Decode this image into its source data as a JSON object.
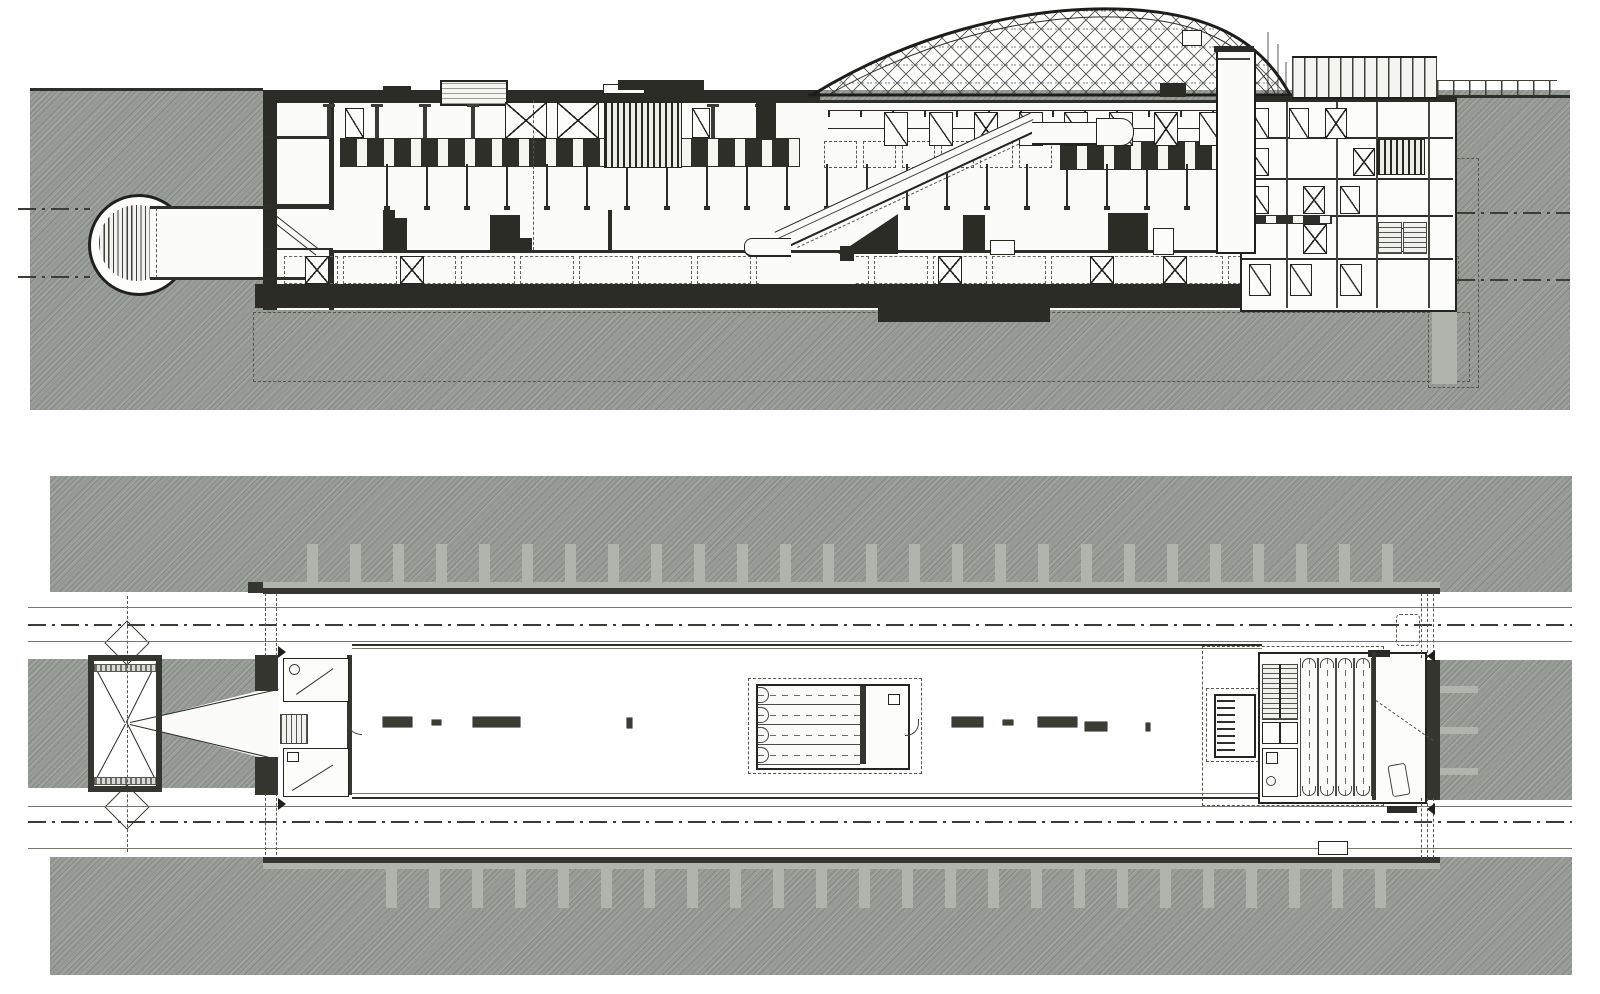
{
  "drawing": {
    "kind": "architectural-drawing",
    "views": [
      {
        "id": "section",
        "semantic": "longitudinal-section-of-underground-station"
      },
      {
        "id": "plan",
        "semantic": "platform-level-plan"
      }
    ],
    "has_text": false
  },
  "palette": {
    "paper": "#ffffff",
    "drawing_white": "#fbfbf9",
    "earth_hatch": "#989d97",
    "light_gray": "#b1b4ad",
    "wall_dark": "#35362f",
    "slab_dark": "#2b2c26",
    "ink": "#1f201b",
    "line_gray": "#74766f",
    "dash_gray": "#54554e"
  },
  "section": {
    "hangers": {
      "x0": 386,
      "pitch": 40,
      "count": 22,
      "y": 164,
      "w": 2,
      "h": 42
    },
    "concourse_columns": {
      "x0": 327,
      "pitch": 48,
      "count": 10,
      "y": 104,
      "w": 4,
      "h": 34
    },
    "underplatform_panels": {
      "x0": 284,
      "pitch": 59,
      "count": 20,
      "y": 256,
      "w": 52,
      "h": 26
    },
    "underplatform_xdoors": {
      "xs": [
        305,
        400,
        938,
        1090,
        1163
      ],
      "y": 256,
      "w": 22,
      "h": 26
    },
    "dashed_bays": {
      "x0": 824,
      "pitch": 39,
      "count": 6,
      "y": 141,
      "w": 31,
      "h": 25
    },
    "concourse_doors": {
      "x0": 884,
      "pitch": 45,
      "count": 8,
      "y": 112,
      "w": 22,
      "h": 32,
      "x_marked": [
        2,
        6
      ]
    },
    "platform_blocks": [
      {
        "x": 383,
        "y": 218,
        "w": 24,
        "h": 32
      },
      {
        "x": 383,
        "y": 210,
        "w": 12,
        "h": 8
      },
      {
        "x": 490,
        "y": 215,
        "w": 30,
        "h": 35
      },
      {
        "x": 520,
        "y": 238,
        "w": 12,
        "h": 12
      },
      {
        "x": 608,
        "y": 210,
        "w": 4,
        "h": 40
      },
      {
        "x": 963,
        "y": 215,
        "w": 22,
        "h": 38
      },
      {
        "x": 1108,
        "y": 213,
        "w": 40,
        "h": 40
      },
      {
        "x": 840,
        "y": 246,
        "w": 14,
        "h": 15
      }
    ],
    "platform_white_boxes": [
      {
        "x": 990,
        "y": 240,
        "w": 23,
        "h": 13
      },
      {
        "x": 1153,
        "y": 228,
        "w": 19,
        "h": 25
      },
      {
        "x": 1396,
        "y": 228,
        "w": 8,
        "h": 22
      }
    ],
    "dome": {
      "x": 798,
      "y": 2,
      "w": 500,
      "h": 97,
      "base_y": 93,
      "apex_x": 318,
      "apex_y": 7
    }
  },
  "plan": {
    "ribs_top": {
      "x0": 307,
      "pitch": 43,
      "count": 26,
      "y": 544,
      "w": 11,
      "h": 44
    },
    "ribs_bottom": {
      "x0": 386,
      "pitch": 43,
      "count": 24,
      "y": 864,
      "w": 11,
      "h": 44
    },
    "ribs_right": {
      "x": 1440,
      "y0": 686,
      "pitch": 41,
      "count": 3,
      "w": 38,
      "h": 7
    },
    "benches": [
      {
        "x": 383,
        "y": 717,
        "w": 29,
        "h": 10
      },
      {
        "x": 432,
        "y": 720,
        "w": 9,
        "h": 5
      },
      {
        "x": 473,
        "y": 717,
        "w": 47,
        "h": 10
      },
      {
        "x": 627,
        "y": 718,
        "w": 5,
        "h": 10
      },
      {
        "x": 952,
        "y": 717,
        "w": 31,
        "h": 10
      },
      {
        "x": 1003,
        "y": 720,
        "w": 10,
        "h": 5
      },
      {
        "x": 1038,
        "y": 717,
        "w": 39,
        "h": 10
      },
      {
        "x": 1085,
        "y": 722,
        "w": 22,
        "h": 9
      },
      {
        "x": 1146,
        "y": 723,
        "w": 4,
        "h": 8
      }
    ],
    "escalator_bank_mid": {
      "x": 758,
      "y0": 686,
      "pitch": 20,
      "count": 4,
      "w": 102,
      "h": 18
    },
    "escalator_bank_core": {
      "x0": 1300,
      "pitch": 18,
      "count": 4,
      "y": 658,
      "w": 16,
      "h": 138
    },
    "track_centerlines_y": [
      624,
      821
    ],
    "platform_edges_y": [
      645,
      797
    ]
  }
}
